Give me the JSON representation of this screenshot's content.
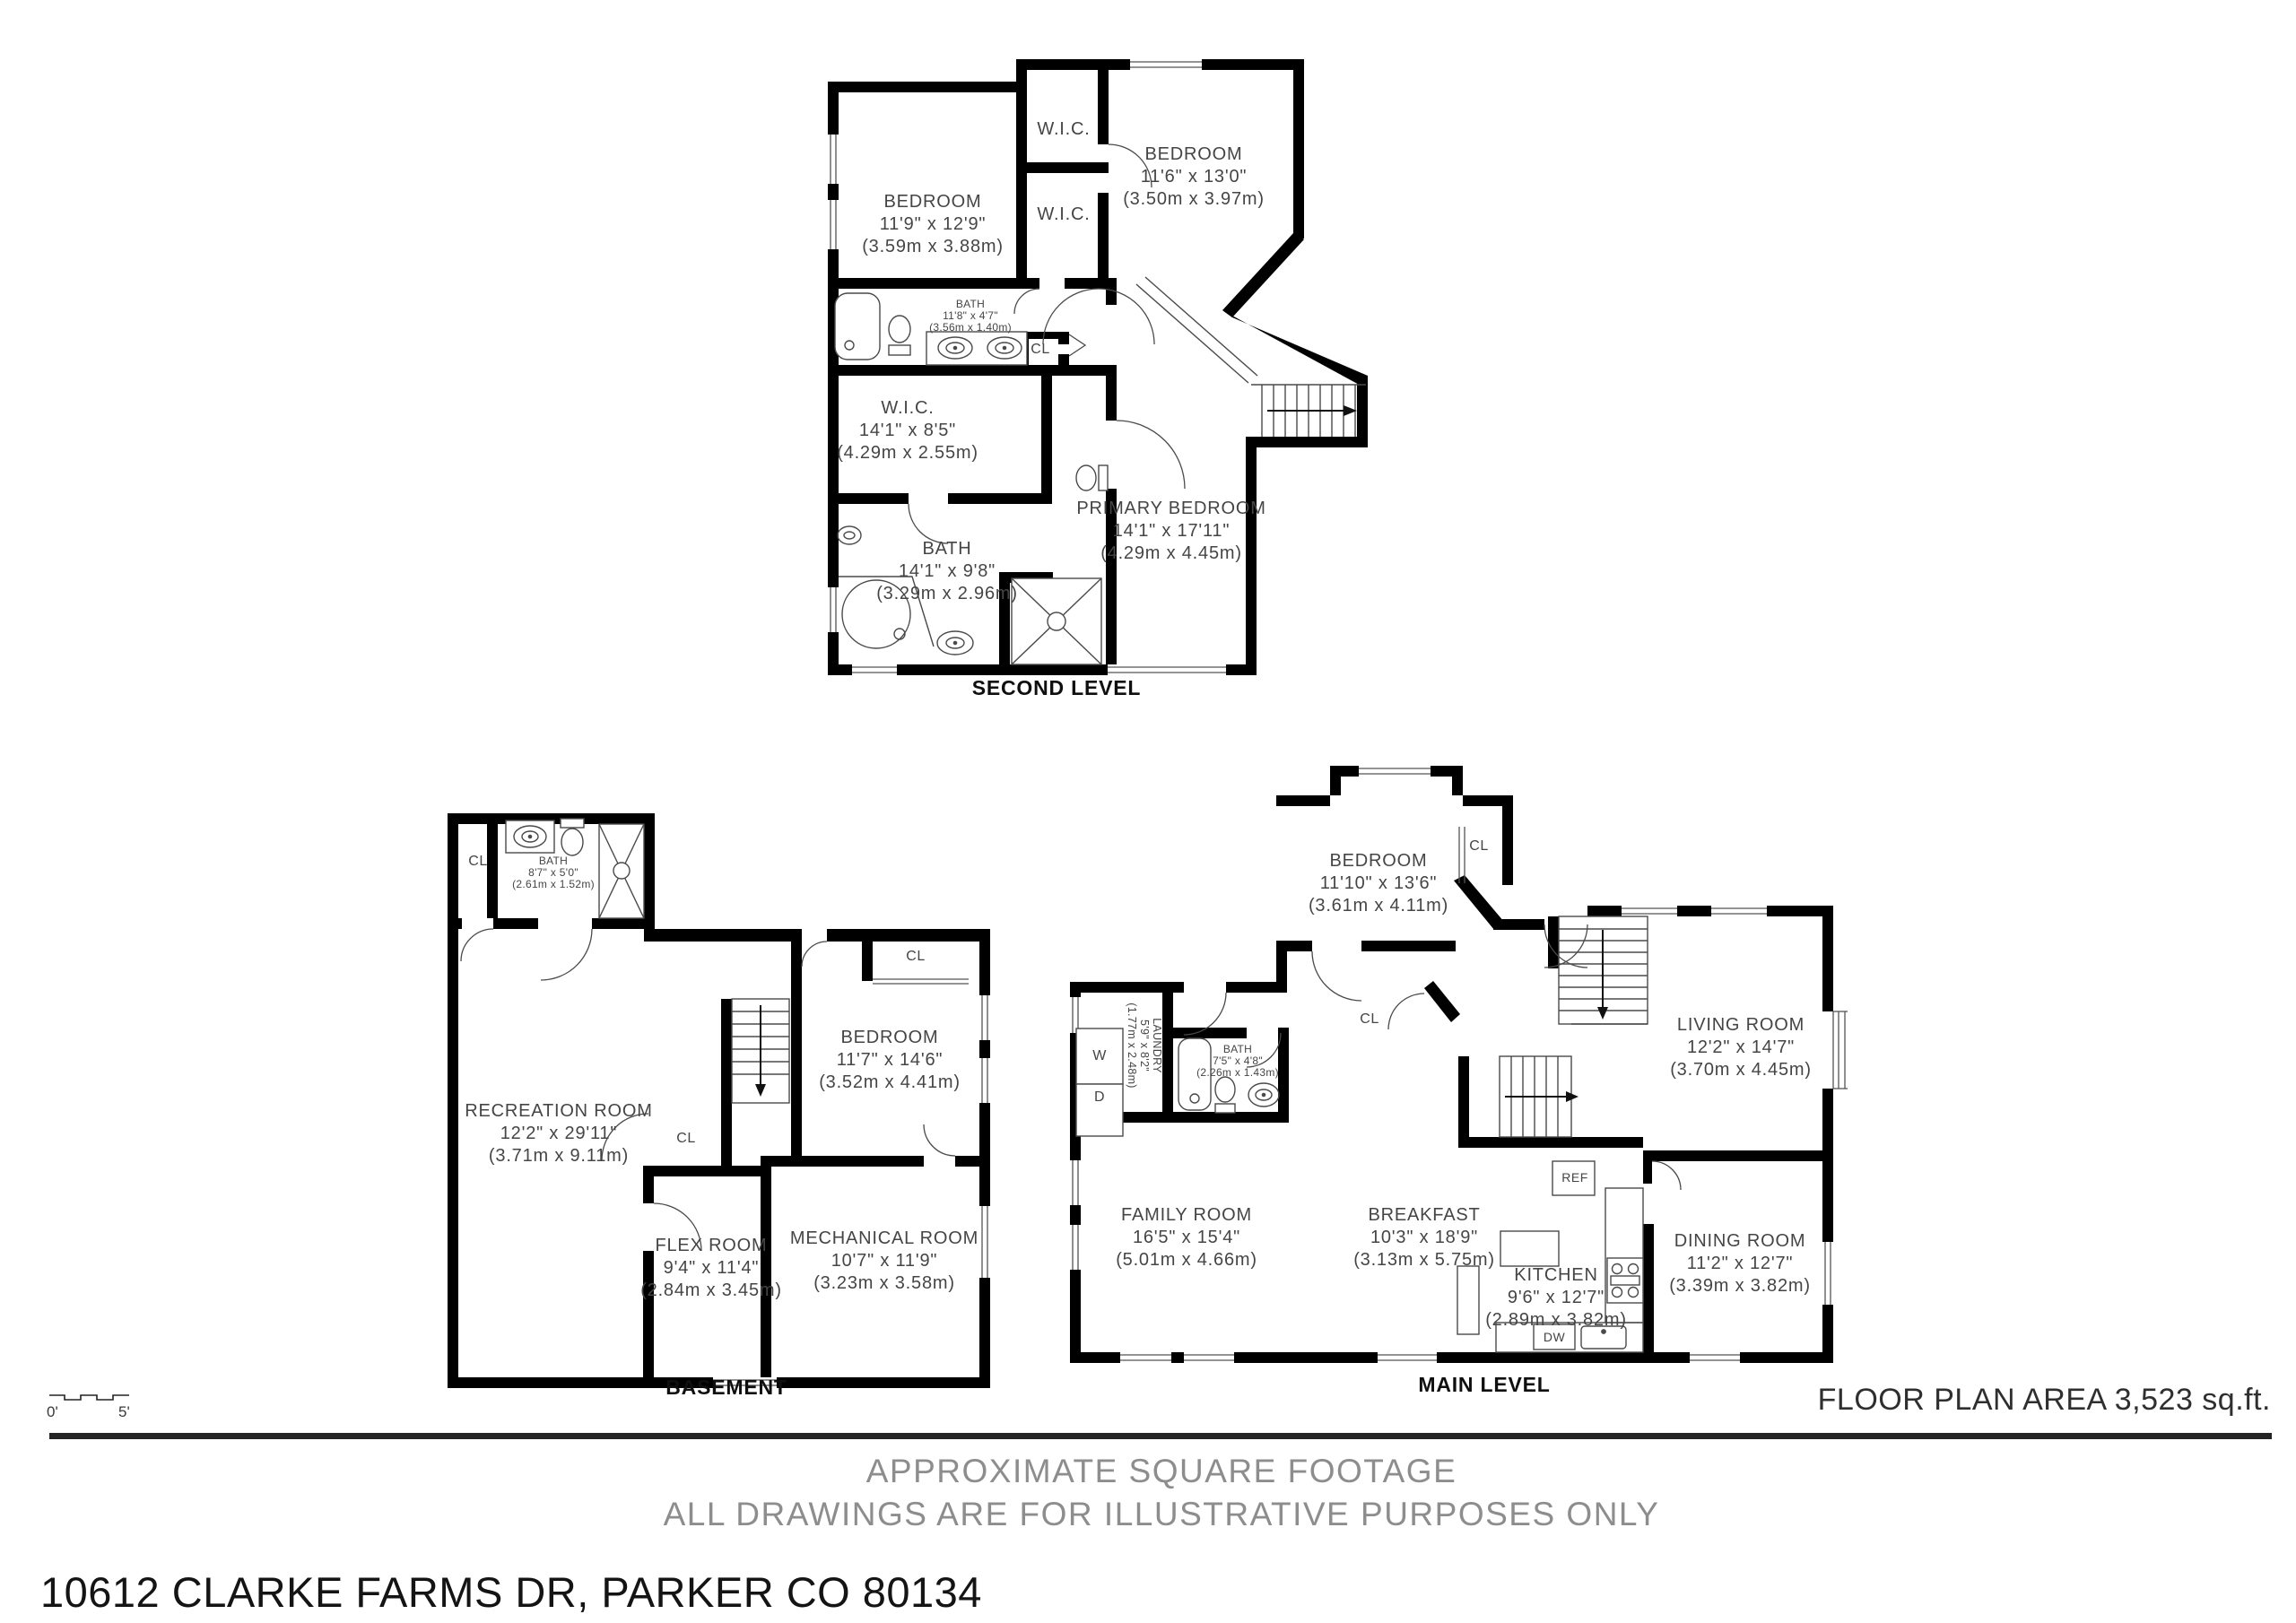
{
  "colors": {
    "wall": "#000000",
    "label": "#454545",
    "footer_gray": "#8d8d8d",
    "accent_dark": "#242424"
  },
  "plans": {
    "second_level": {
      "caption": "SECOND LEVEL",
      "rooms": {
        "bedroom_left": {
          "name": "BEDROOM",
          "imperial": "11'9\" x 12'9\"",
          "metric": "(3.59m x 3.88m)"
        },
        "wic_top": {
          "name": "W.I.C."
        },
        "wic_mid": {
          "name": "W.I.C."
        },
        "bedroom_right": {
          "name": "BEDROOM",
          "imperial": "11'6\" x 13'0\"",
          "metric": "(3.50m x 3.97m)"
        },
        "bath_hall": {
          "name": "BATH",
          "imperial": "11'8\" x 4'7\"",
          "metric": "(3.56m x 1.40m)"
        },
        "closet_hall": {
          "name": "CL"
        },
        "wic_primary": {
          "name": "W.I.C.",
          "imperial": "14'1\" x 8'5\"",
          "metric": "(4.29m x 2.55m)"
        },
        "primary_bedroom": {
          "name": "PRIMARY BEDROOM",
          "imperial": "14'1\" x 17'11\"",
          "metric": "(4.29m x 4.45m)"
        },
        "bath_primary": {
          "name": "BATH",
          "imperial": "14'1\" x 9'8\"",
          "metric": "(3.29m x 2.96m)"
        }
      }
    },
    "basement": {
      "caption": "BASEMENT",
      "rooms": {
        "closet_top": {
          "name": "CL"
        },
        "bath": {
          "name": "BATH",
          "imperial": "8'7\" x 5'0\"",
          "metric": "(2.61m x 1.52m)"
        },
        "closet_bedroom": {
          "name": "CL"
        },
        "bedroom": {
          "name": "BEDROOM",
          "imperial": "11'7\" x 14'6\"",
          "metric": "(3.52m x 4.41m)"
        },
        "recreation": {
          "name": "RECREATION ROOM",
          "imperial": "12'2\" x 29'11\"",
          "metric": "(3.71m x 9.11m)"
        },
        "closet_stairs": {
          "name": "CL"
        },
        "flex": {
          "name": "FLEX ROOM",
          "imperial": "9'4\" x 11'4\"",
          "metric": "(2.84m x 3.45m)"
        },
        "mechanical": {
          "name": "MECHANICAL ROOM",
          "imperial": "10'7\" x 11'9\"",
          "metric": "(3.23m x 3.58m)"
        }
      }
    },
    "main_level": {
      "caption": "MAIN LEVEL",
      "rooms": {
        "bedroom": {
          "name": "BEDROOM",
          "imperial": "11'10\" x 13'6\"",
          "metric": "(3.61m x 4.11m)"
        },
        "closet_bedroom": {
          "name": "CL"
        },
        "laundry": {
          "name": "LAUNDRY",
          "imperial": "5'9\" x 8'2\"",
          "metric": "(1.77m x 2.48m)"
        },
        "bath": {
          "name": "BATH",
          "imperial": "7'5\" x 4'8\"",
          "metric": "(2.26m x 1.43m)"
        },
        "closet_hall": {
          "name": "CL"
        },
        "living": {
          "name": "LIVING ROOM",
          "imperial": "12'2\" x 14'7\"",
          "metric": "(3.70m x 4.45m)"
        },
        "family": {
          "name": "FAMILY ROOM",
          "imperial": "16'5\" x 15'4\"",
          "metric": "(5.01m x 4.66m)"
        },
        "breakfast": {
          "name": "BREAKFAST",
          "imperial": "10'3\" x 18'9\"",
          "metric": "(3.13m x 5.75m)"
        },
        "kitchen": {
          "name": "KITCHEN",
          "imperial": "9'6\" x 12'7\"",
          "metric": "(2.89m x 3.82m)"
        },
        "dining": {
          "name": "DINING ROOM",
          "imperial": "11'2\" x 12'7\"",
          "metric": "(3.39m x 3.82m)"
        }
      },
      "appliances": {
        "washer": "W",
        "dryer": "D",
        "refrigerator": "REF",
        "dishwasher": "DW"
      }
    }
  },
  "scale_bar": {
    "start": "0'",
    "end": "5'"
  },
  "footer": {
    "area": "FLOOR PLAN AREA 3,523 sq.ft.",
    "note1": "APPROXIMATE SQUARE FOOTAGE",
    "note2": "ALL DRAWINGS ARE FOR ILLUSTRATIVE PURPOSES ONLY",
    "address": "10612 CLARKE FARMS DR, PARKER CO 80134"
  }
}
